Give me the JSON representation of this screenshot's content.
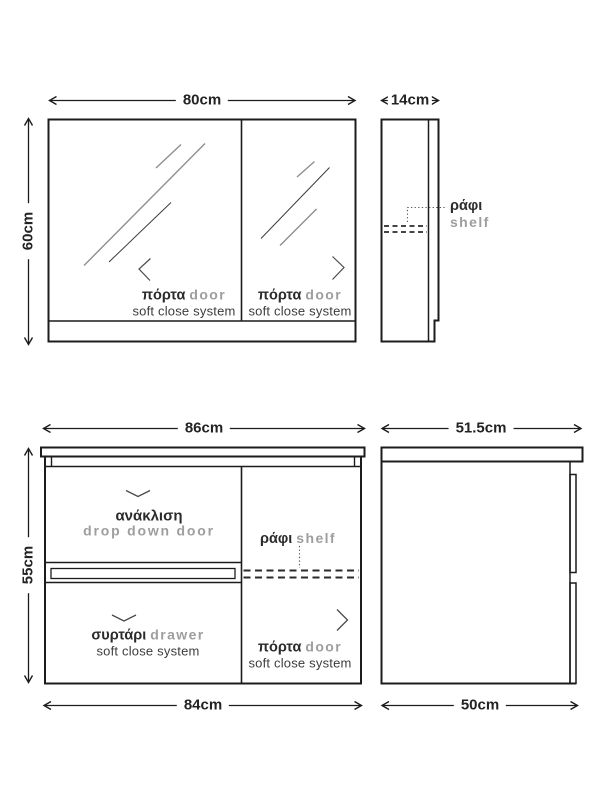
{
  "colors": {
    "line": "#1c1c1c",
    "greek_text": "#2b2b2b",
    "english_text": "#9e9e9e",
    "note_text": "#3d3d3d",
    "mirror_hatch": "#8f8f8f",
    "background": "#ffffff"
  },
  "top_front": {
    "dim_width": "80cm",
    "dim_height": "60cm",
    "doors": [
      {
        "el": "πόρτα",
        "en": "door",
        "note": "soft close system"
      },
      {
        "el": "πόρτα",
        "en": "door",
        "note": "soft close system"
      }
    ]
  },
  "top_side": {
    "dim_depth": "14cm",
    "shelf_el": "ράφι",
    "shelf_en": "shelf"
  },
  "bottom_front": {
    "dim_width_top": "86cm",
    "dim_width_bottom": "84cm",
    "dim_height": "55cm",
    "flap_el": "ανάκλιση",
    "flap_en": "drop down door",
    "shelf_el": "ράφι",
    "shelf_en": "shelf",
    "drawer_el": "συρτάρι",
    "drawer_en": "drawer",
    "drawer_note": "soft close system",
    "door_el": "πόρτα",
    "door_en": "door",
    "door_note": "soft close system"
  },
  "bottom_side": {
    "dim_depth_top": "51.5cm",
    "dim_depth_bottom": "50cm"
  }
}
